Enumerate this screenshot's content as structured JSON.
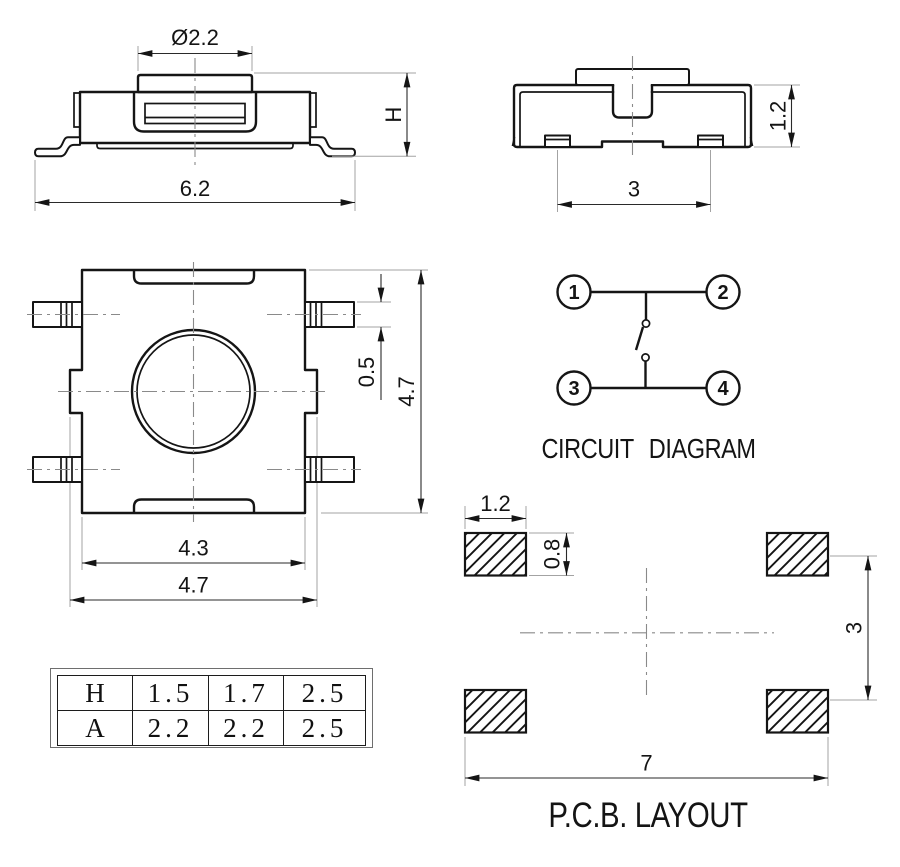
{
  "colors": {
    "background": "#ffffff",
    "line": "#151515",
    "extension_line": "#a3a3a3",
    "centerline": "#8a8a8a"
  },
  "front_view": {
    "dim_button_dia": "Ø2.2",
    "dim_height": "H",
    "dim_overall_width": "6.2"
  },
  "side_view": {
    "dim_body_height": "1.2",
    "dim_terminal_pitch": "3"
  },
  "top_view": {
    "dim_lead_width": "0.5",
    "dim_overall_height": "4.7",
    "dim_body_width": "4.3",
    "dim_overall_width": "4.7"
  },
  "circuit_diagram": {
    "title": "CIRCUIT DIAGRAM",
    "terminals": [
      "1",
      "2",
      "3",
      "4"
    ]
  },
  "pcb_layout": {
    "title": "P.C.B. LAYOUT",
    "dim_pad_width": "1.2",
    "dim_pad_height": "0.8",
    "dim_row_pitch": "3",
    "dim_span": "7"
  },
  "spec_table": {
    "rows": [
      {
        "label": "H",
        "values": [
          "1.5",
          "1.7",
          "2.5"
        ]
      },
      {
        "label": "A",
        "values": [
          "2.2",
          "2.2",
          "2.5"
        ]
      }
    ]
  }
}
